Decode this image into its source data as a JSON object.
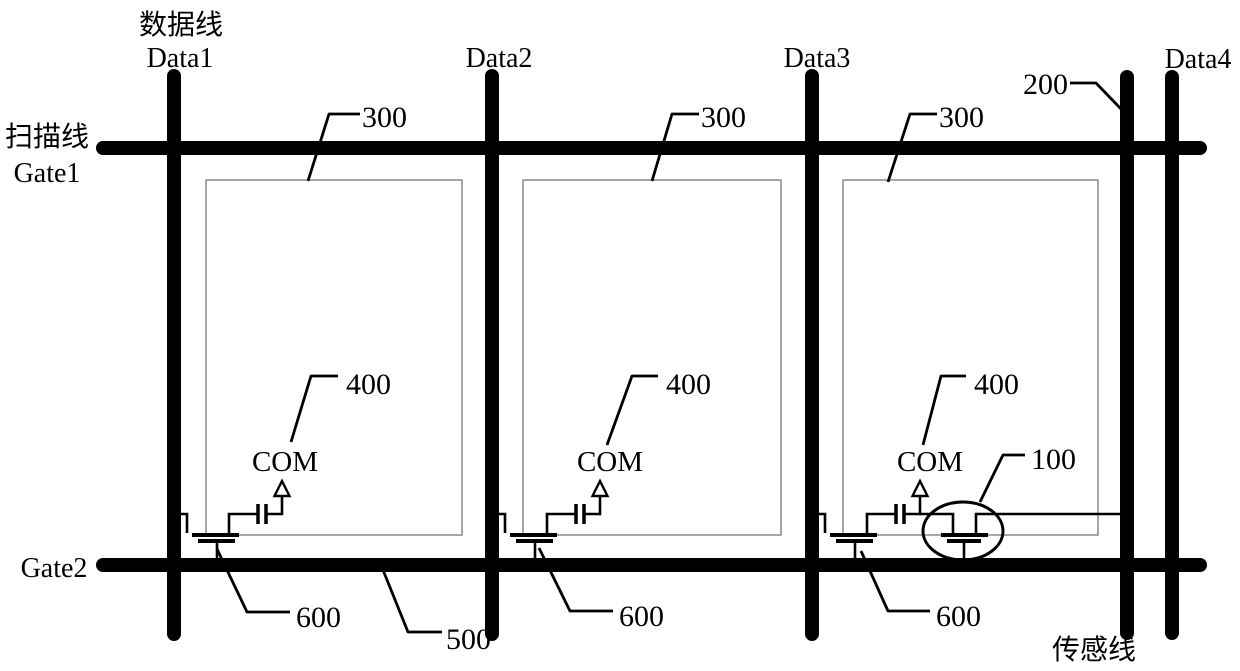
{
  "title_labels": {
    "data_line_cn": "数据线",
    "scan_line_cn": "扫描线",
    "sense_line_cn": "传感线"
  },
  "line_labels": {
    "data1": "Data1",
    "data2": "Data2",
    "data3": "Data3",
    "data4": "Data4",
    "gate1": "Gate1",
    "gate2": "Gate2"
  },
  "node_labels": {
    "com": "COM"
  },
  "reference_numerals": {
    "ref_100": "100",
    "ref_200": "200",
    "ref_300": "300",
    "ref_400": "400",
    "ref_500": "500",
    "ref_600": "600"
  },
  "colors": {
    "ink": "#000000",
    "background": "#ffffff",
    "pixel_box_stroke": "#808080"
  }
}
